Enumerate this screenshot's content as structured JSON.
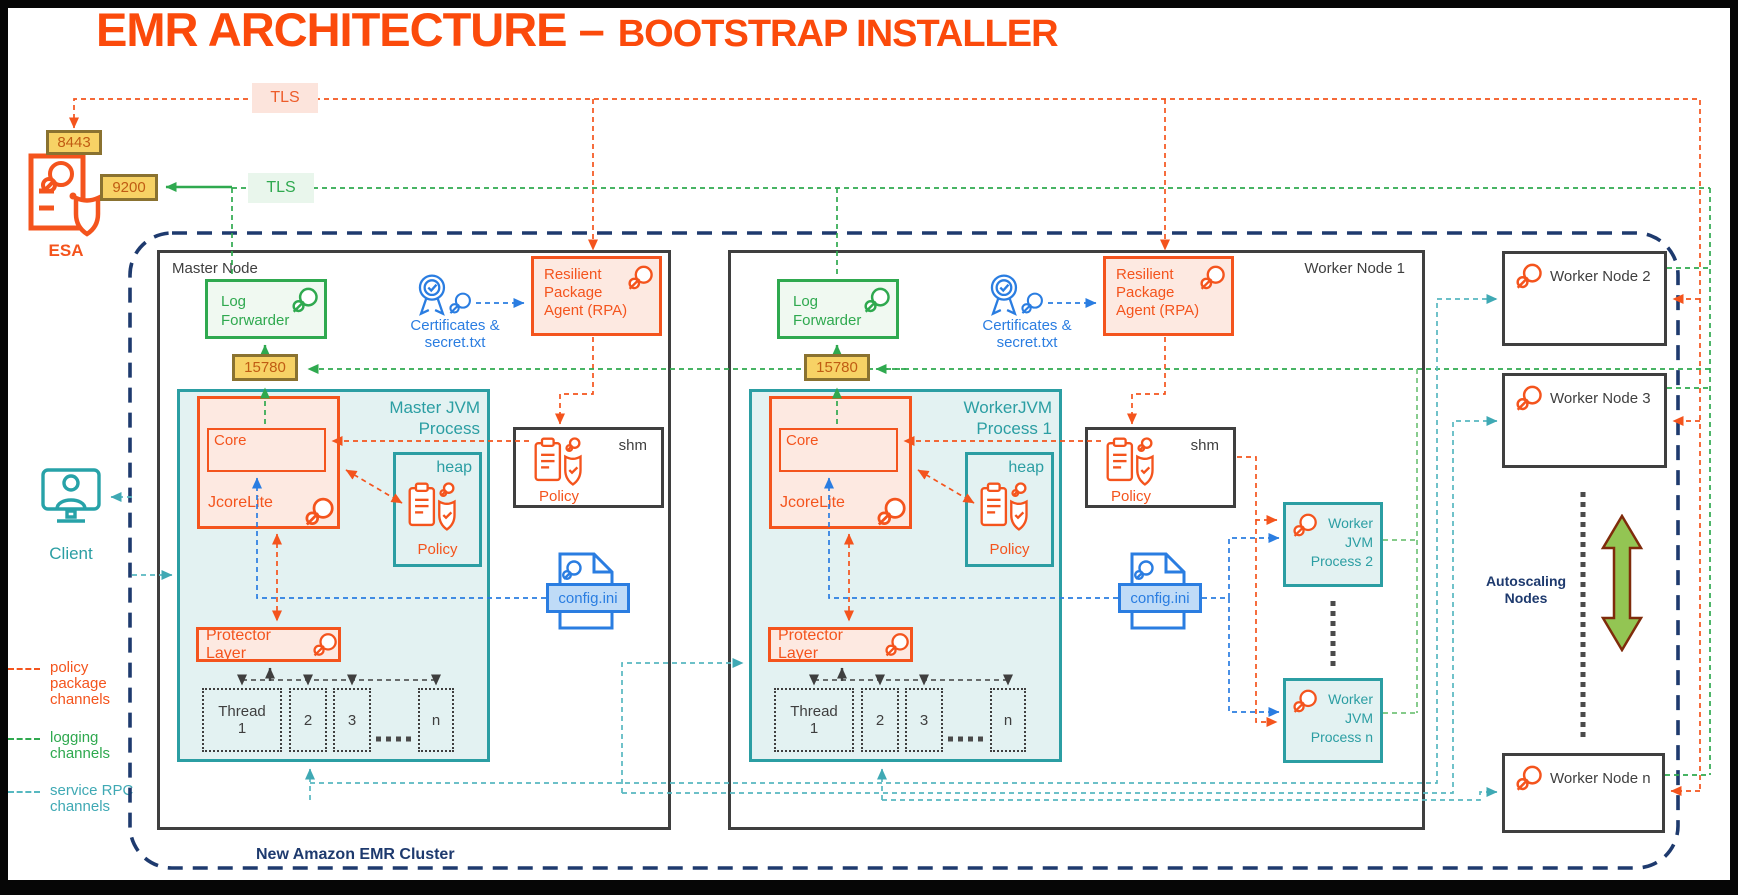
{
  "title": {
    "main": "EMR ARCHITECTURE –",
    "sub": "BOOTSTRAP INSTALLER"
  },
  "tls_labels": {
    "policy": "TLS",
    "logging": "TLS"
  },
  "esa": {
    "label": "ESA",
    "port_top": "8443",
    "port_side": "9200"
  },
  "client": {
    "label": "Client"
  },
  "legend": [
    {
      "label": "policy package channels"
    },
    {
      "label": "logging channels"
    },
    {
      "label": "service RPC channels"
    }
  ],
  "cluster": {
    "label": "New Amazon EMR Cluster"
  },
  "master": {
    "title": "Master Node",
    "log_forwarder": "Log Forwarder",
    "port": "15780",
    "certificates": "Certificates & secret.txt",
    "rpa": "Resilient Package Agent (RPA)",
    "jvm_title": "Master JVM Process",
    "jcorelite": "JcoreLite",
    "core": "Core",
    "heap": "heap",
    "heap_policy": "Policy",
    "protector": "Protector Layer",
    "threads": [
      "Thread 1",
      "2",
      "3",
      "n"
    ],
    "shm": "shm",
    "shm_policy": "Policy",
    "config": "config.ini"
  },
  "worker1": {
    "title": "Worker Node 1",
    "log_forwarder": "Log Forwarder",
    "port": "15780",
    "certificates": "Certificates & secret.txt",
    "rpa": "Resilient Package Agent (RPA)",
    "jvm_title": "WorkerJVM Process 1",
    "jcorelite": "JcoreLite",
    "core": "Core",
    "heap": "heap",
    "heap_policy": "Policy",
    "protector": "Protector Layer",
    "threads": [
      "Thread 1",
      "2",
      "3",
      "n"
    ],
    "shm": "shm",
    "shm_policy": "Policy",
    "config": "config.ini",
    "jvm2": "Worker JVM Process 2",
    "jvmn": "Worker JVM Process n"
  },
  "right_nodes": [
    {
      "label": "Worker Node 2"
    },
    {
      "label": "Worker Node 3"
    },
    {
      "label": "Worker Node n"
    }
  ],
  "autoscaling": {
    "label": "Autoscaling Nodes"
  },
  "colors": {
    "orange": "#F4541D",
    "green": "#2FA94F",
    "teal": "#2B9EA3",
    "service_rpc_teal": "#57B8C0",
    "blue": "#2A7DE1",
    "navy": "#1E3A6E",
    "port_badge_bg": "#F7D265",
    "port_badge_border": "#8A7230",
    "title_orange": "#FB4A0B",
    "autoscale_green": "#93C553"
  }
}
